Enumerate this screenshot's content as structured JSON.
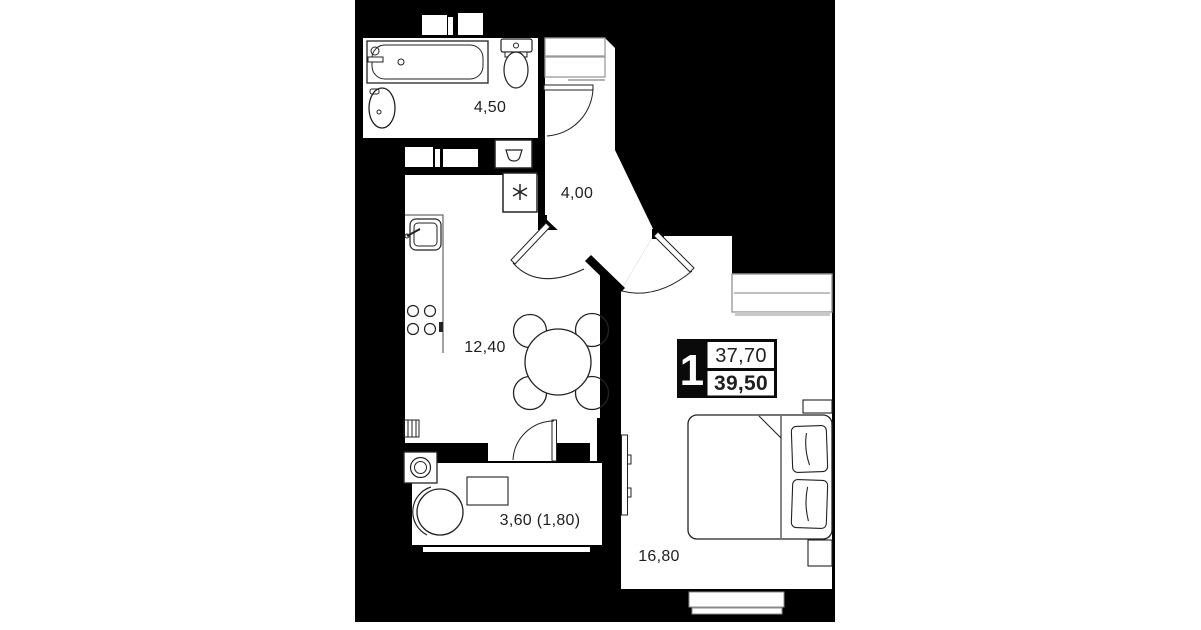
{
  "page": {
    "background": "#ffffff",
    "canvas_background": "#000000",
    "ink_color": "#1f1f1f"
  },
  "floorplan": {
    "unit_badge": {
      "rooms_count": "1",
      "area_upper": "37,70",
      "area_lower": "39,50"
    },
    "room_labels": {
      "bathroom": "4,50",
      "hallway": "4,00",
      "kitchen_living": "12,40",
      "balcony": "3,60 (1,80)",
      "bedroom": "16,80"
    },
    "icons": {
      "washing_machine_symbol": "six-spoke asterisk",
      "sink_unit_symbol": "bowl"
    }
  }
}
